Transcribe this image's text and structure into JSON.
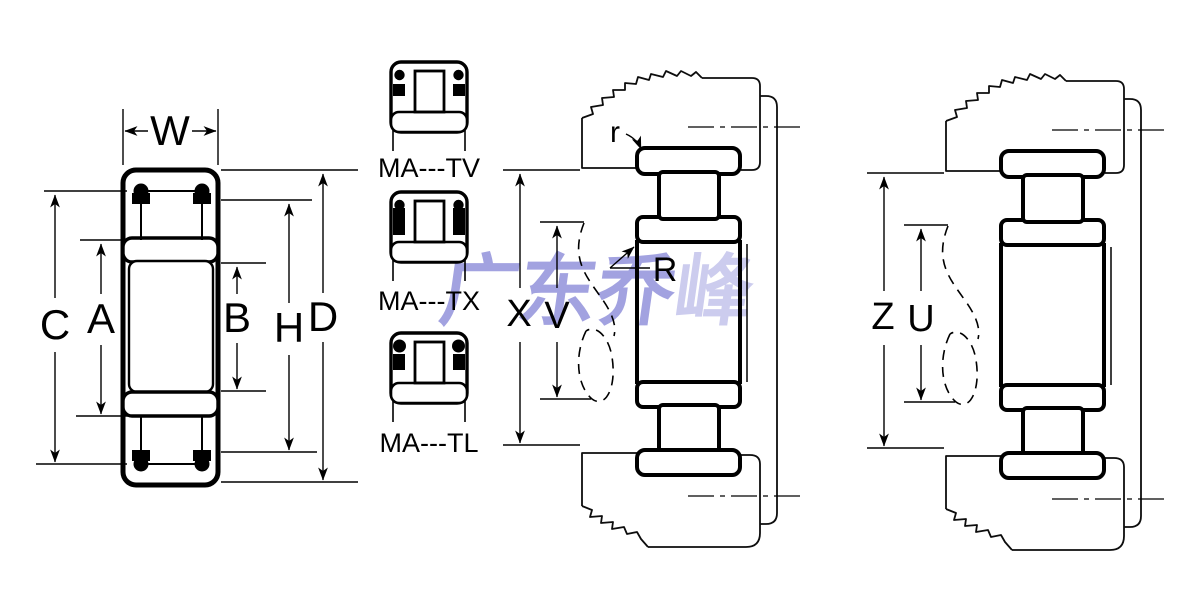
{
  "page": {
    "background": "#ffffff",
    "line_color": "#000000"
  },
  "watermark": {
    "text": "广东乔峰",
    "text_main": "广东乔",
    "text_tail": "峰",
    "color": "#8b8bd8"
  },
  "left_figure": {
    "labels": {
      "w": "W",
      "c": "C",
      "a": "A",
      "b": "B",
      "h": "H",
      "d": "D"
    }
  },
  "type_icons": [
    {
      "label": "MA---TV"
    },
    {
      "label": "MA---TX"
    },
    {
      "label": "MA---TL"
    }
  ],
  "center_assembly": {
    "labels": {
      "r_small": "r",
      "r_big": "R",
      "x": "X",
      "v": "V"
    }
  },
  "right_assembly": {
    "labels": {
      "z": "Z",
      "u": "U"
    }
  }
}
